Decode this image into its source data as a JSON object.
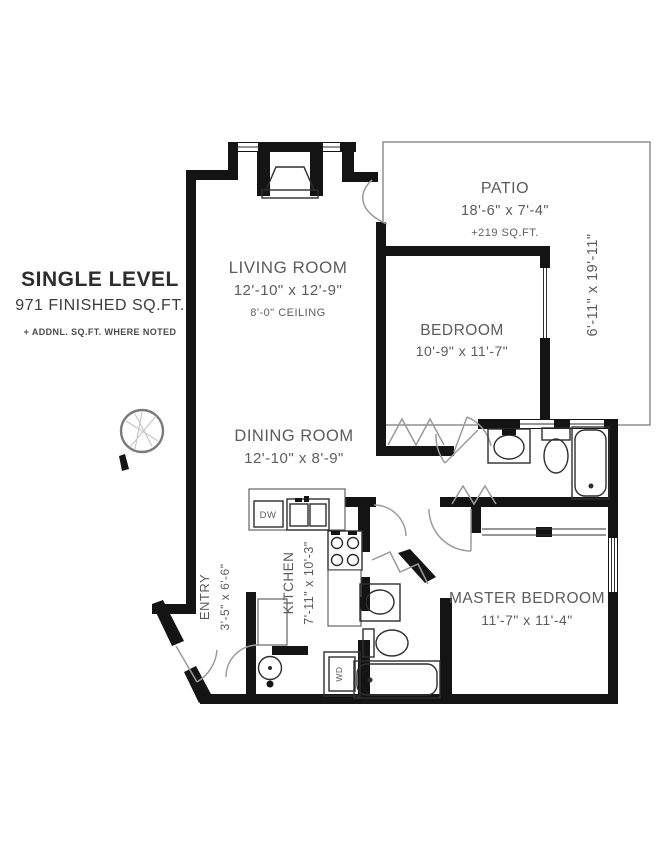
{
  "plan": {
    "title": "SINGLE LEVEL",
    "area": "971 FINISHED SQ.FT.",
    "note": "+ ADDNL. SQ.FT. WHERE NOTED"
  },
  "rooms": {
    "living": {
      "name": "LIVING ROOM",
      "dims": "12'-10\" x 12'-9\"",
      "ceiling": "8'-0\" CEILING"
    },
    "patio": {
      "name": "PATIO",
      "dims": "18'-6\" x 7'-4\"",
      "extra": "+219 SQ.FT.",
      "side_dims": "6'-11\" x 19'-11\""
    },
    "bedroom": {
      "name": "BEDROOM",
      "dims": "10'-9\" x 11'-7\""
    },
    "dining": {
      "name": "DINING ROOM",
      "dims": "12'-10\" x 8'-9\""
    },
    "kitchen": {
      "name": "KITCHEN",
      "dims": "7'-11\" x 10'-3\""
    },
    "entry": {
      "name": "ENTRY",
      "dims": "3'-5\" x 6'-6\""
    },
    "master": {
      "name": "MASTER BEDROOM",
      "dims": "11'-7\" x 11'-4\""
    }
  },
  "appliances": {
    "dishwasher": "DW",
    "washer_dryer": "WD"
  },
  "colors": {
    "wall": "#141414",
    "label_text": "#5c5c5c",
    "title_text": "#2d2d2d",
    "patio_outline": "#8f8f8f"
  }
}
